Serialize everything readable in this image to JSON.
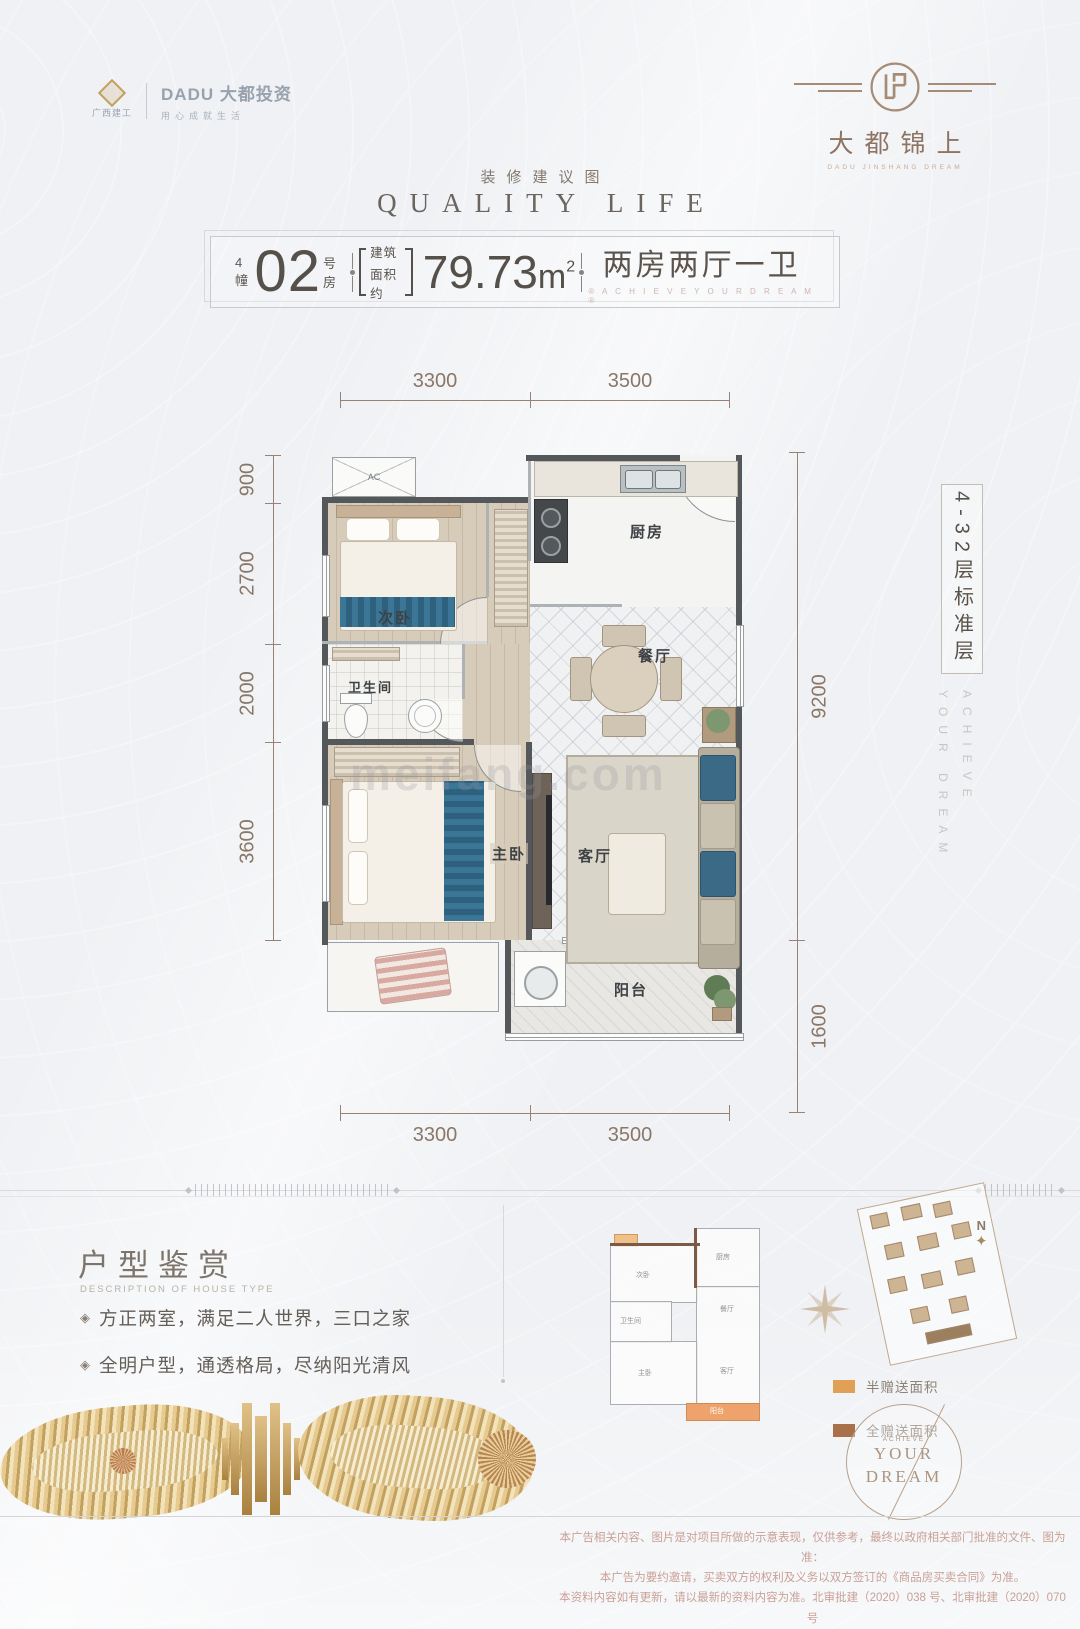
{
  "brand": {
    "builder_name": "广西建工",
    "group_name": "DADU 大都投资",
    "tagline": "用心成就生活",
    "project_name": "大都锦上",
    "project_sub": "DADU JINSHANG DREAM"
  },
  "header": {
    "suggestion_cn": "装修建议图",
    "suggestion_en": "QUALITY LIFE"
  },
  "spec": {
    "block_prefix": "4幢",
    "unit": "02",
    "unit_suffix": "号房",
    "area_label_top": "建筑",
    "area_label_bottom": "面积约",
    "area_value": "79.73",
    "area_unit": "m",
    "area_sup": "2",
    "rooms_text": "两房两厅一卫",
    "slogan": "® A C H I E V E  Y O U R  D R E A M ®"
  },
  "dims": {
    "top_a": "3300",
    "top_b": "3500",
    "bottom_a": "3300",
    "bottom_b": "3500",
    "left_a": "900",
    "left_b": "2700",
    "left_c": "2000",
    "left_d": "3600",
    "right_a": "9200",
    "right_b": "1600"
  },
  "plan": {
    "ac": "AC",
    "watermark": "meifang.com",
    "rooms": {
      "bedroom2": "次卧",
      "kitchen": "厨房",
      "dining": "餐厅",
      "bathroom": "卫生间",
      "master": "主卧",
      "living": "客厅",
      "balcony": "阳台"
    }
  },
  "side": {
    "floors": "4-32层标准层",
    "slogan_left": "YOUR DREAM",
    "slogan_right": "ACHIEVE"
  },
  "appreciation": {
    "title": "户型鉴赏",
    "subtitle": "DESCRIPTION OF HOUSE TYPE",
    "bullet_icon": "◈",
    "bullet1": "方正两室，满足二人世界，三口之家",
    "bullet2": "全明户型，通透格局，尽纳阳光清风"
  },
  "legend": {
    "half": {
      "label": "半赠送面积",
      "color": "#e0a055"
    },
    "full": {
      "label": "全赠送面积",
      "color": "#a9714a"
    }
  },
  "siteplan": {
    "north": "N"
  },
  "stamp": {
    "line1": "ACHIEVE",
    "line2": "YOUR",
    "line3": "DREAM"
  },
  "disclaimer": {
    "line1": "本广告相关内容、图片是对项目所做的示意表现，仅供参考，最终以政府相关部门批准的文件、图为准：",
    "line2": "本广告为要约邀请，买卖双方的权利及义务以双方签订的《商品房买卖合同》为准。",
    "line3": "本资料内容如有更新，请以最新的资料内容为准。北审批建（2020）038 号、北审批建（2020）070 号"
  }
}
